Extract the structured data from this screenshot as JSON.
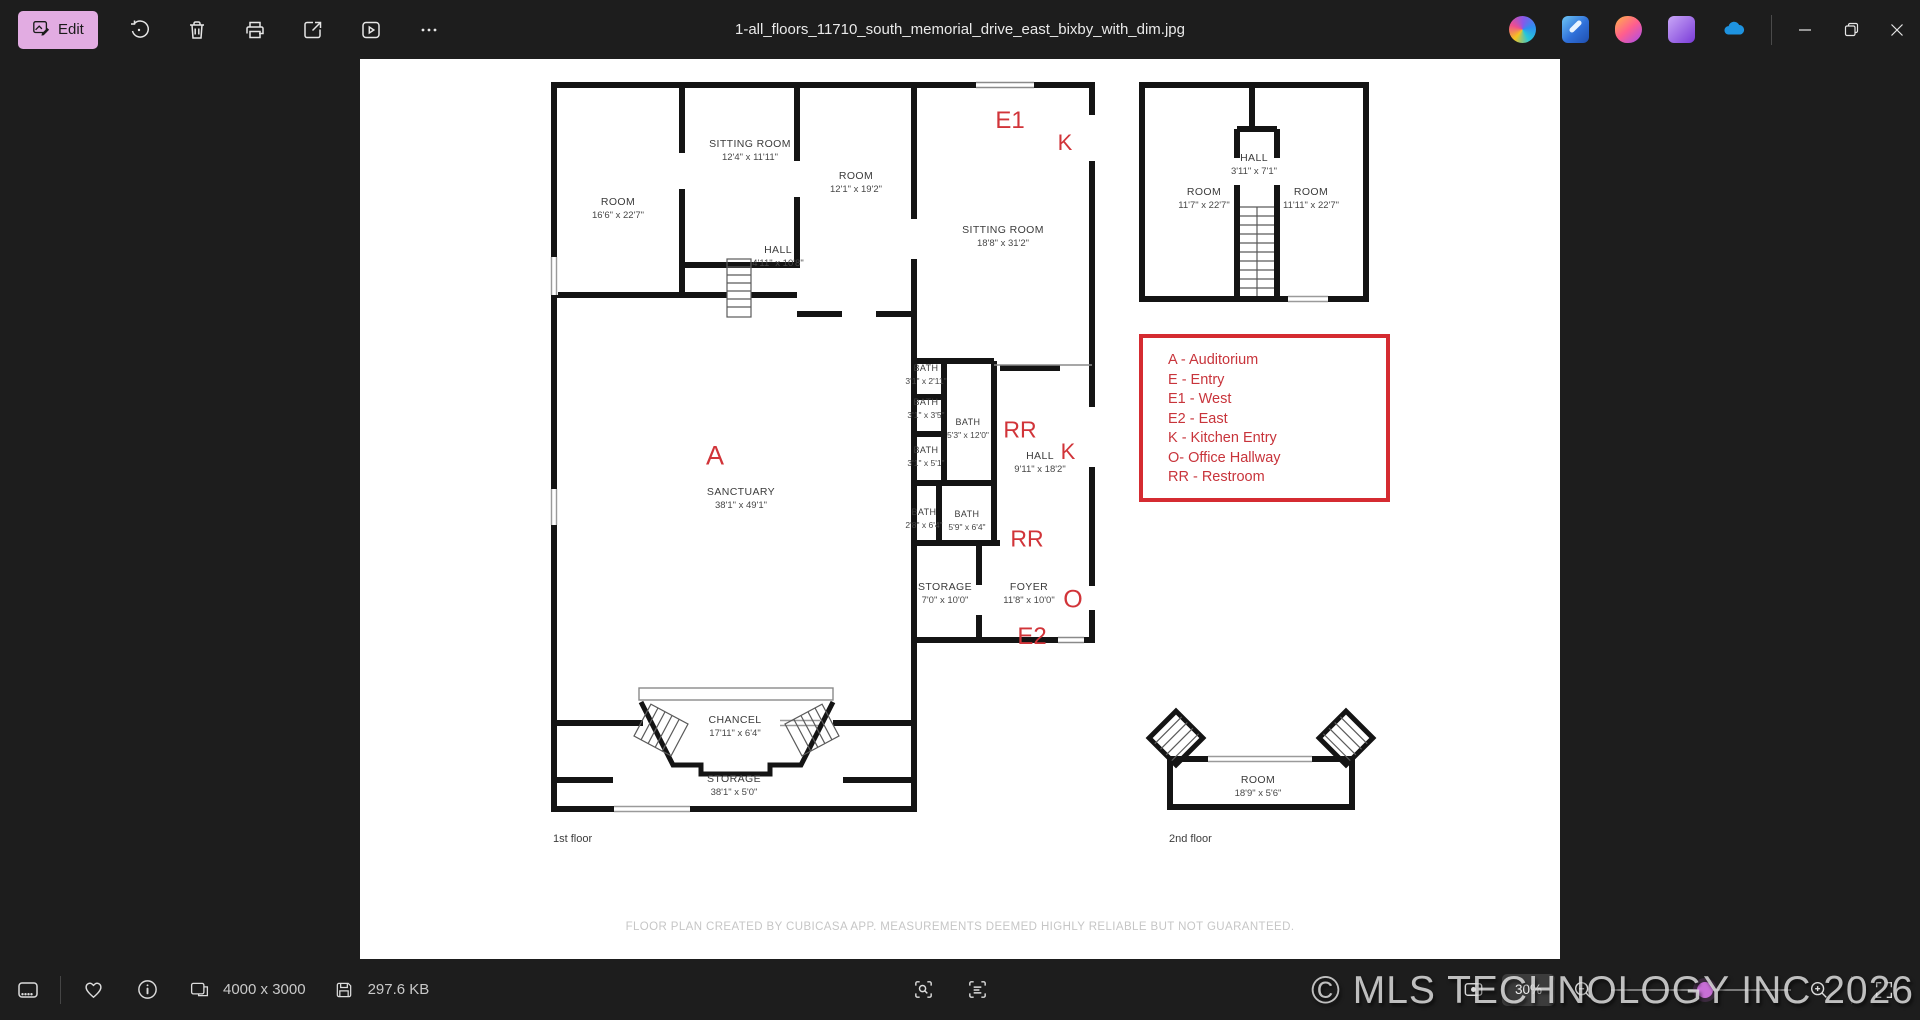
{
  "titlebar": {
    "title": "1-all_floors_11710_south_memorial_drive_east_bixby_with_dim.jpg",
    "edit_label": "Edit"
  },
  "statusbar": {
    "dimensions": "4000 x 3000",
    "file_size": "297.6 KB",
    "zoom_level": "30%"
  },
  "watermark": "© MLS TECHNOLOGY INC 2026",
  "floorplan": {
    "floor1_label": "1st floor",
    "floor2_label": "2nd floor",
    "footer": "FLOOR PLAN CREATED BY CUBICASA APP. MEASUREMENTS DEEMED HIGHLY RELIABLE BUT NOT GUARANTEED.",
    "legend": [
      "A - Auditorium",
      "E - Entry",
      "E1 - West",
      "E2 - East",
      "K - Kitchen Entry",
      "O- Office Hallway",
      "RR - Restroom"
    ],
    "markers": [
      {
        "text": "E1"
      },
      {
        "text": "K"
      },
      {
        "text": "A"
      },
      {
        "text": "RR"
      },
      {
        "text": "K"
      },
      {
        "text": "RR"
      },
      {
        "text": "O"
      },
      {
        "text": "E2"
      }
    ],
    "floor1_rooms": [
      {
        "name": "SITTING ROOM",
        "dims": "12'4\" x 11'11\""
      },
      {
        "name": "ROOM",
        "dims": "12'1\" x 19'2\""
      },
      {
        "name": "ROOM",
        "dims": "16'6\" x 22'7\""
      },
      {
        "name": "HALL",
        "dims": "4'11\" x 10'8\""
      },
      {
        "name": "SITTING ROOM",
        "dims": "18'8\" x 31'2\""
      },
      {
        "name": "BATH",
        "dims": "3'1\" x 2'11\""
      },
      {
        "name": "BATH",
        "dims": "3'1\" x 3'5\""
      },
      {
        "name": "BATH",
        "dims": "5'3\" x 12'0\""
      },
      {
        "name": "BATH",
        "dims": "3'1\" x 5'1\""
      },
      {
        "name": "BATH",
        "dims": "2'8\" x 6'4\""
      },
      {
        "name": "BATH",
        "dims": "5'9\" x 6'4\""
      },
      {
        "name": "HALL",
        "dims": "9'11\" x 18'2\""
      },
      {
        "name": "STORAGE",
        "dims": "7'0\" x 10'0\""
      },
      {
        "name": "FOYER",
        "dims": "11'8\" x 10'0\""
      },
      {
        "name": "SANCTUARY",
        "dims": "38'1\" x 49'1\""
      },
      {
        "name": "CHANCEL",
        "dims": "17'11\" x 6'4\""
      },
      {
        "name": "STORAGE",
        "dims": "38'1\" x 5'0\""
      }
    ],
    "floor2_rooms": [
      {
        "name": "ROOM",
        "dims": "11'7\" x 22'7\""
      },
      {
        "name": "HALL",
        "dims": "3'11\" x 7'1\""
      },
      {
        "name": "ROOM",
        "dims": "11'11\" x 22'7\""
      },
      {
        "name": "ROOM",
        "dims": "18'9\" x 5'6\""
      }
    ]
  }
}
